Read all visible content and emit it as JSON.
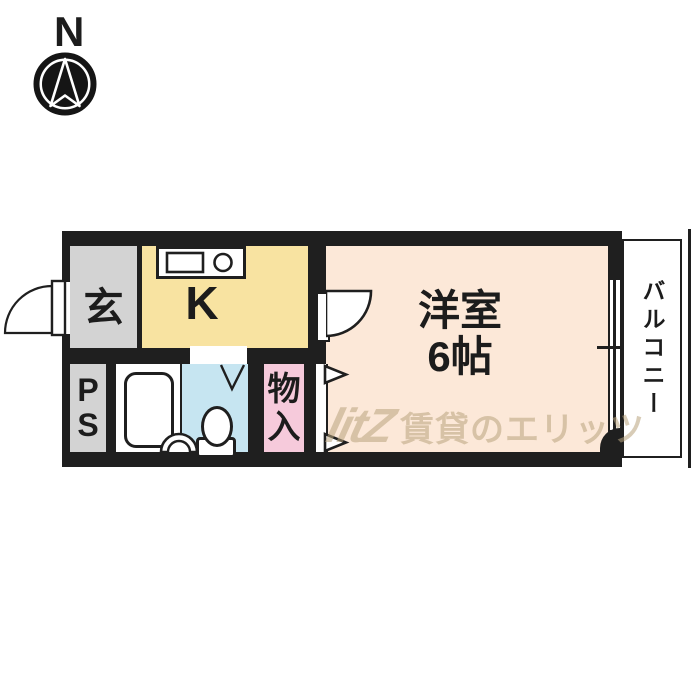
{
  "compass": {
    "label": "N"
  },
  "floorplan": {
    "wall_color": "#1f1f1f",
    "rooms": {
      "entrance": {
        "label": "玄",
        "color": "#d3d3d3"
      },
      "kitchen": {
        "label": "K",
        "color": "#f8e3a1"
      },
      "western_room": {
        "lines": [
          "洋室",
          "6帖"
        ],
        "color": "#fce8d8"
      },
      "pipe_space": {
        "lines": [
          "P",
          "S"
        ],
        "color": "#d3d3d3"
      },
      "bathroom": {
        "color": "#ffffff"
      },
      "toilet_room": {
        "color": "#c6e5f1"
      },
      "closet": {
        "lines": [
          "物",
          "入"
        ],
        "color": "#f6cadb"
      },
      "balcony": {
        "label": "バルコニー",
        "color": "#ffffff"
      }
    }
  },
  "watermark": {
    "logo": "litZ",
    "text": "賃貸のエリッツ",
    "color": "#b9a47e"
  }
}
